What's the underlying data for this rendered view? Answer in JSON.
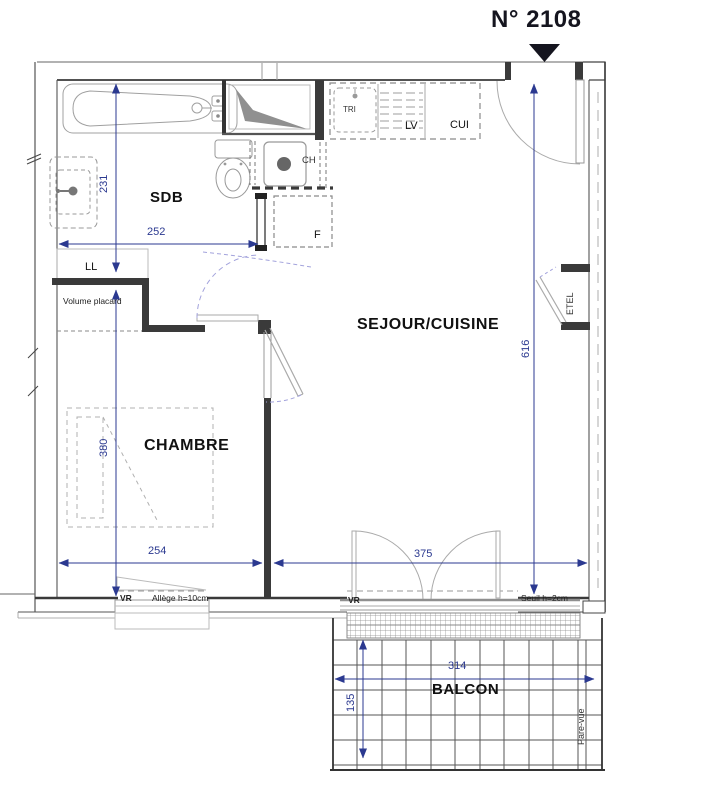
{
  "title": {
    "unit": "N° 2108"
  },
  "rooms": {
    "sdb": "SDB",
    "sejour_cuisine": "SEJOUR/CUISINE",
    "chambre": "CHAMBRE",
    "balcon": "BALCON"
  },
  "fixtures": {
    "tri": "TRI",
    "lv": "LV",
    "cui": "CUI",
    "ch": "CH",
    "fridge": "F",
    "ll": "LL",
    "etel": "ETEL",
    "volume_placard": "Volume placard",
    "pare_vue": "Pare-vue"
  },
  "openings": {
    "vr_chambre": "VR",
    "allege_chambre": "Allège h=10cm",
    "vr_sejour": "VR",
    "seuil_sejour": "Seuil h=2cm"
  },
  "dimensions_cm": {
    "sdb_width": "252",
    "sdb_depth": "231",
    "chambre_width": "254",
    "chambre_depth": "380",
    "sejour_width": "375",
    "sejour_depth": "616",
    "balcon_width": "314",
    "balcon_depth": "135"
  },
  "colors": {
    "dimension_blue": "#2b3990",
    "wall_dark": "#3a3a3a",
    "fixture_gray": "#a0a0a0",
    "door_swing_lavender": "#a3a3dc"
  }
}
